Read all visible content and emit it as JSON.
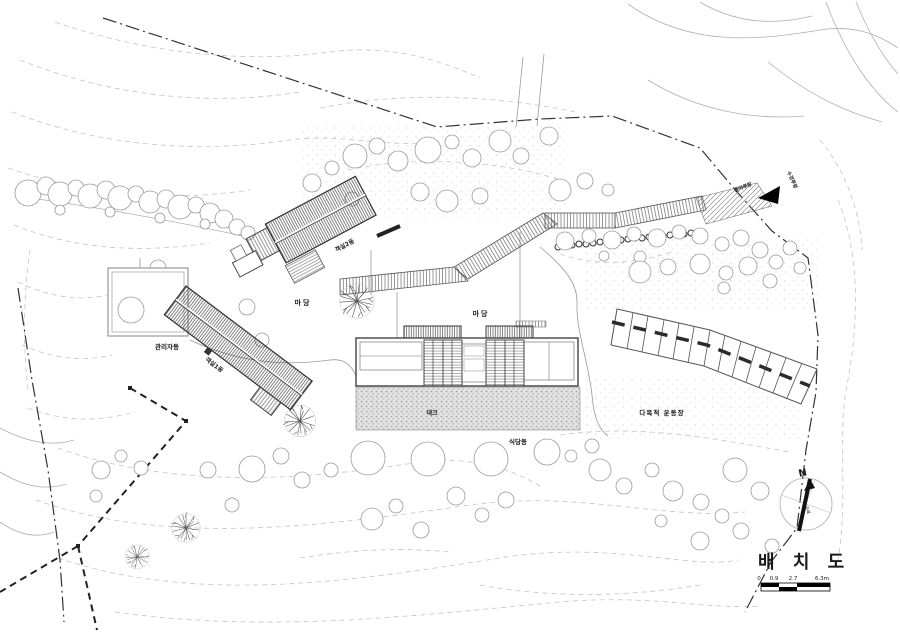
{
  "drawing": {
    "title": "배 치 도",
    "scale_bar": {
      "ticks": [
        "0",
        "0.9",
        "2.7",
        "6.3m"
      ]
    },
    "buildings": {
      "admin": "관리자동",
      "guest1": "객실1동",
      "guest2": "객실2동",
      "dining": "식당동"
    },
    "areas": {
      "yard_west": "마당",
      "yard_center": "마당",
      "deck": "데크",
      "playground": "다목적 운동장"
    },
    "entrance": {
      "path_label": "들머루랑",
      "side_label": "수경루랑"
    },
    "compass": {
      "north": "N",
      "note": "자북"
    }
  },
  "colors": {
    "ink": "#1a1a1a",
    "line": "#444444",
    "contour": "#c4c4c4",
    "light": "#9a9a9a",
    "black": "#000000"
  }
}
